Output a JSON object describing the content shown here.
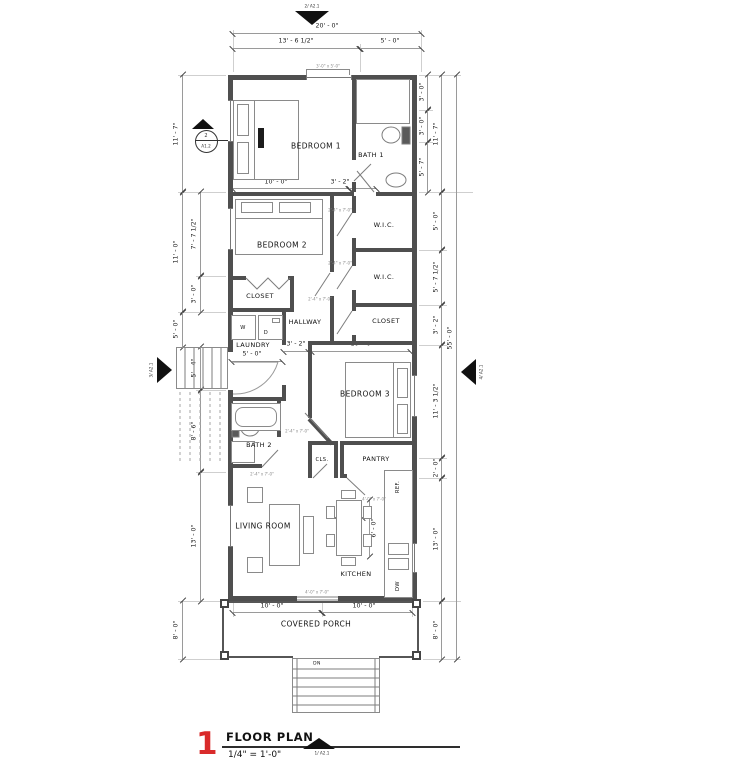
{
  "title_block": {
    "number": "1",
    "title": "FLOOR PLAN",
    "scale": "1/4\" = 1'-0\""
  },
  "view_markers": {
    "top": "2/ A2.1",
    "bottom": "1/ A2.1",
    "left": "3/ A2.1",
    "right": "4/ A2.1",
    "section_number": "2",
    "section_sheet": "A1.2"
  },
  "rooms": {
    "bedroom1": "BEDROOM 1",
    "bath1": "BATH 1",
    "bedroom2": "BEDROOM 2",
    "wic1": "W.I.C.",
    "wic2": "W.I.C.",
    "closet1": "CLOSET",
    "hallway": "HALLWAY",
    "closet2": "CLOSET",
    "laundry": "LAUNDRY",
    "bath2": "BATH 2",
    "bedroom3": "BEDROOM 3",
    "cls": "CLS.",
    "pantry": "PANTRY",
    "living": "LIVING ROOM",
    "kitchen": "KITCHEN",
    "porch": "COVERED PORCH"
  },
  "labels": {
    "ref": "REF.",
    "dw": "DW",
    "washer": "W",
    "dryer": "D",
    "down": "DN"
  },
  "dims": {
    "top_overall": "20' - 0\"",
    "top_left": "13' - 6 1/2\"",
    "top_right": "5' - 0\"",
    "left_bed1": "11' - 7\"",
    "left_bed2": "11' - 0\"",
    "left_inner_a": "7' - 7 1/2\"",
    "left_inner_b": "3' - 0\"",
    "left_stair_outer": "5' - 0\"",
    "left_stair_inner": "5' - 4\"",
    "left_bath2": "8' - 6\"",
    "left_living": "13' - 0\"",
    "left_porch": "8' - 0\"",
    "right_shower": "3' - 0\"",
    "right_toilet": "3' - 0\"",
    "right_bath": "5' - 7\"",
    "right_bed1": "11' - 7\"",
    "right_wic1": "5' - 0\"",
    "right_wic2": "5' - 7 1/2\"",
    "right_closet": "3' - 2\"",
    "right_overall": "55' - 0\"",
    "right_bed3": "11' - 3 1/2\"",
    "right_pantry": "2' - 0\"",
    "right_kitchen": "13' - 0\"",
    "right_porch": "8' - 0\"",
    "bed1_width": "10' - 0\"",
    "bed1_bath": "3' - 2\"",
    "hall_width": "3' - 2\"",
    "bed3_width": "10' - 0\"",
    "laundry_width": "5' - 0\"",
    "table_width": "3' - 0\"",
    "table_depth": "6' - 0\"",
    "bottom_left": "10' - 0\"",
    "bottom_right": "10' - 0\""
  },
  "tags": {
    "door": "2'-4\" x 7'-0\"",
    "window": "3'-0\" x 5'-0\"",
    "double_door": "4'-0\" x 7'-0\""
  },
  "colors": {
    "accent": "#d92b2b",
    "wall": "#4f4f4f",
    "line": "#8a8a8a"
  }
}
